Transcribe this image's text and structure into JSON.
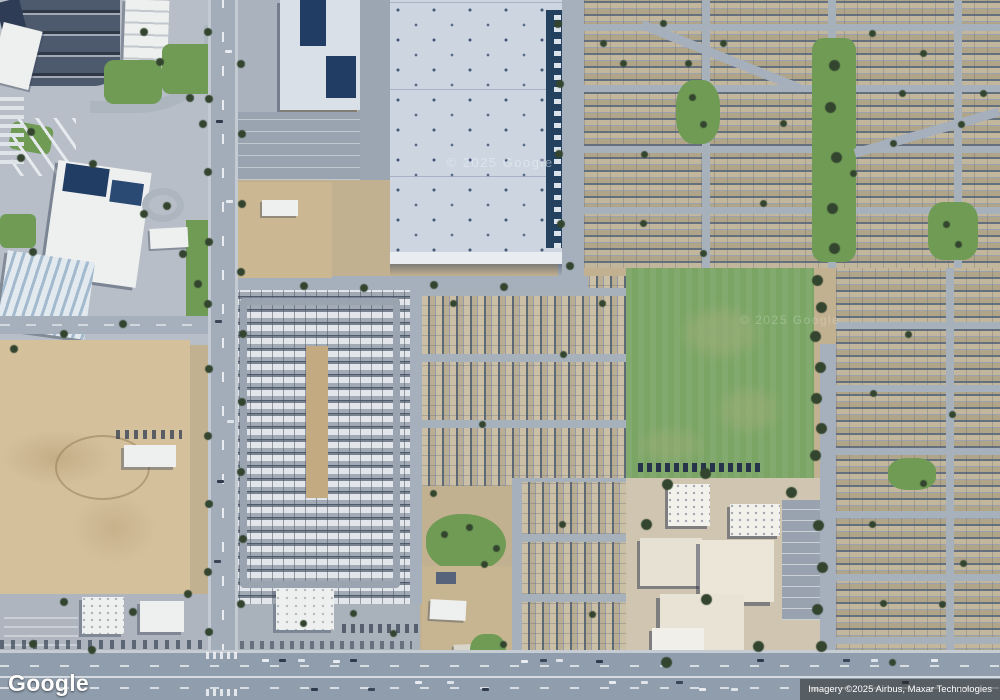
{
  "branding": {
    "logo_text": "Google"
  },
  "attribution": {
    "text": "Imagery ©2025 Airbus, Maxar Technologies"
  },
  "watermarks": {
    "roof": "© 2025 Google",
    "field": "© 2025 Google"
  },
  "colors": {
    "desert": "#c2b190",
    "dirt": "#d4c09b",
    "road": "#a6b0bc",
    "road_major": "#8f9dac",
    "asphalt_dark": "#4d5a6e",
    "pavement": "#b4bbc4",
    "building_white": "#eef0ef",
    "roof_navy": "#213d63",
    "warehouse_roof": "#ccd5e0",
    "grass": "#7ba565",
    "lawn": "#6f9b55",
    "tree": "#33452f",
    "mhp_ground": "#8f98a5",
    "school_concrete": "#cfc5b0",
    "field_patch": "#9fae7c"
  }
}
